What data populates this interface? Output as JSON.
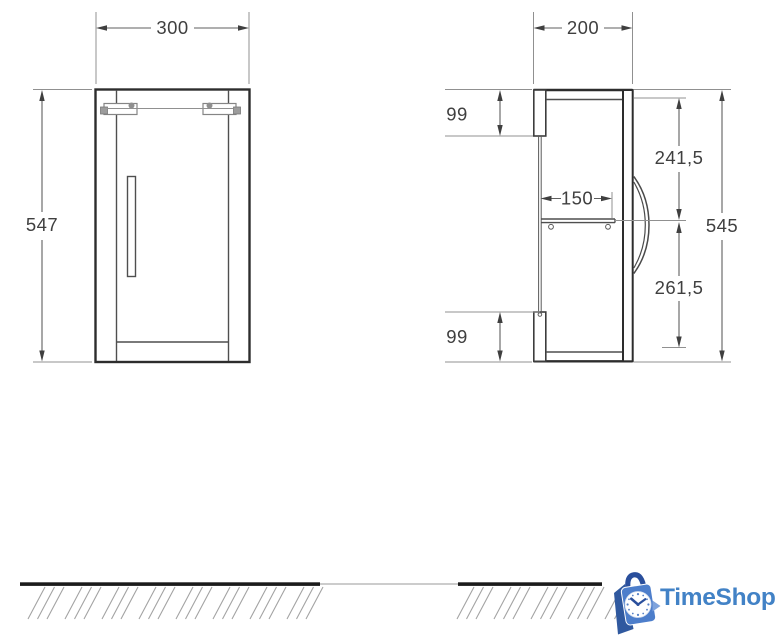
{
  "drawing": {
    "front_view": {
      "width_label": "300",
      "height_label": "547"
    },
    "side_view": {
      "depth_label": "200",
      "height_label": "545",
      "top_mount_label": "99",
      "upper_section_label": "241,5",
      "shelf_depth_label": "150",
      "lower_section_label": "261,5",
      "bottom_mount_label": "99"
    }
  },
  "branding": {
    "name": "TimeShop",
    "text_color": "#4282c6",
    "bag_front_color": "#4d7ecb",
    "bag_side_color": "#30599f",
    "handle_color": "#2a4f9c",
    "notch_color": "#7fa3dc"
  }
}
